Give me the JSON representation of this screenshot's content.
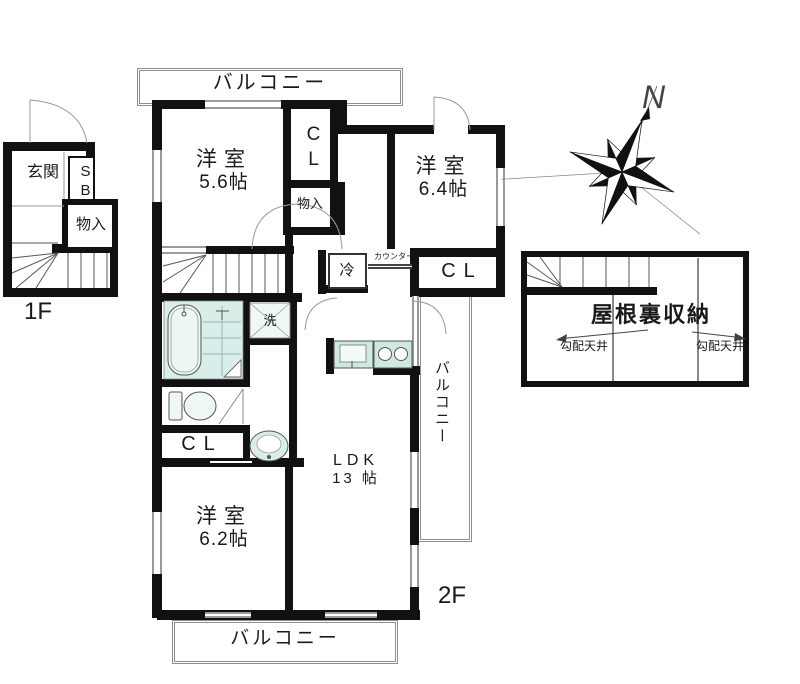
{
  "floor1": {
    "label": "1F",
    "entrance": "玄関",
    "shoe_box": "SB",
    "storage": "物入"
  },
  "floor2": {
    "label": "2F",
    "balcony_top": "バルコニー",
    "balcony_right": "バルコニー",
    "balcony_bottom": "バルコニー",
    "room_nw": {
      "name": "洋室",
      "size": "5.6帖"
    },
    "room_ne": {
      "name": "洋室",
      "size": "6.4帖"
    },
    "room_sw": {
      "name": "洋室",
      "size": "6.2帖"
    },
    "ldk": {
      "name": "LDK",
      "size": "13 帖"
    },
    "closet_nw": "CL",
    "closet_ne": "CL",
    "closet_sw": "CL",
    "storage": "物入",
    "fridge": "冷",
    "counter": "カウンター",
    "laundry": "洗"
  },
  "attic": {
    "name": "屋根裏収納",
    "slope_left": "勾配天井",
    "slope_right": "勾配天井"
  },
  "compass": {
    "north": "N"
  },
  "colors": {
    "wall": "#111111",
    "window": "#9a9a9a",
    "fixture_fill": "#d9ede9",
    "fixture_light": "#eef7f4"
  }
}
